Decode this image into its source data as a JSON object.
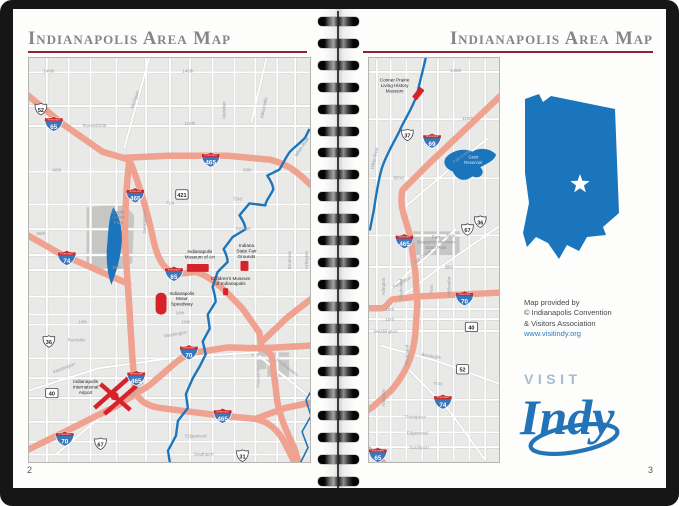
{
  "window": {
    "left_title": "Indianapolis Area Map",
    "right_title": "Indianapolis Area Map",
    "left_page_number": "2",
    "right_page_number": "3"
  },
  "colors": {
    "highway_salmon": "#efa28f",
    "water_blue": "#1b75bc",
    "interstate_blue": "#3b76ba",
    "interstate_red": "#c42c30",
    "poi_red": "#d6232b",
    "state_blue": "#1b75bc",
    "title_gray": "#85868b",
    "rule_maroon": "#8e2133",
    "logo_blue": "#2273b8",
    "visit_gray": "#a5bccf"
  },
  "shield_caption": "INTERSTATE",
  "left_map": {
    "shields": [
      {
        "style": "us",
        "label": "52",
        "x": 12,
        "y": 51
      },
      {
        "style": "interstate",
        "label": "65",
        "x": 25,
        "y": 66
      },
      {
        "style": "interstate",
        "label": "465",
        "x": 183,
        "y": 102
      },
      {
        "style": "box",
        "label": "421",
        "x": 154,
        "y": 137
      },
      {
        "style": "interstate",
        "label": "465",
        "x": 107,
        "y": 138
      },
      {
        "style": "interstate",
        "label": "74",
        "x": 38,
        "y": 201
      },
      {
        "style": "interstate",
        "label": "65",
        "x": 146,
        "y": 217
      },
      {
        "style": "us",
        "label": "36",
        "x": 20,
        "y": 285
      },
      {
        "style": "interstate",
        "label": "70",
        "x": 161,
        "y": 296
      },
      {
        "style": "interstate",
        "label": "465",
        "x": 108,
        "y": 322
      },
      {
        "style": "box",
        "label": "40",
        "x": 23,
        "y": 337
      },
      {
        "style": "interstate",
        "label": "70",
        "x": 36,
        "y": 383
      },
      {
        "style": "us",
        "label": "67",
        "x": 72,
        "y": 388
      },
      {
        "style": "interstate",
        "label": "465",
        "x": 195,
        "y": 360
      },
      {
        "style": "us",
        "label": "31",
        "x": 215,
        "y": 400
      }
    ],
    "labels": [
      {
        "lines": [
          "146th"
        ],
        "x": 20,
        "y": 14
      },
      {
        "lines": [
          "146th"
        ],
        "x": 160,
        "y": 14
      },
      {
        "lines": [
          "Russell/206"
        ],
        "x": 66,
        "y": 69
      },
      {
        "lines": [
          "116th"
        ],
        "x": 162,
        "y": 67
      },
      {
        "lines": [
          "86th"
        ],
        "x": 28,
        "y": 114
      },
      {
        "lines": [
          "86th"
        ],
        "x": 220,
        "y": 114
      },
      {
        "lines": [
          "Michigan"
        ],
        "x": 108,
        "y": 42,
        "rot": -72
      },
      {
        "lines": [
          "Meridian"
        ],
        "x": 198,
        "y": 52,
        "rot": -90
      },
      {
        "lines": [
          "Allisonville"
        ],
        "x": 238,
        "y": 50,
        "rot": -78
      },
      {
        "lines": [
          "71st"
        ],
        "x": 142,
        "y": 147
      },
      {
        "lines": [
          "73rd"
        ],
        "x": 210,
        "y": 143
      },
      {
        "lines": [
          "Georgetown"
        ],
        "x": 118,
        "y": 164,
        "rot": -90
      },
      {
        "lines": [
          "56th"
        ],
        "x": 12,
        "y": 178
      },
      {
        "lines": [
          "Kessler"
        ],
        "x": 216,
        "y": 173
      },
      {
        "lines": [
          "38th"
        ],
        "x": 88,
        "y": 212
      },
      {
        "lines": [
          "16th"
        ],
        "x": 152,
        "y": 258
      },
      {
        "lines": [
          "10th"
        ],
        "x": 54,
        "y": 267
      },
      {
        "lines": [
          "10th"
        ],
        "x": 158,
        "y": 267
      },
      {
        "lines": [
          "Rockville"
        ],
        "x": 48,
        "y": 285
      },
      {
        "lines": [
          "Washington"
        ],
        "x": 148,
        "y": 279,
        "rot": -10
      },
      {
        "lines": [
          "Washington"
        ],
        "x": 36,
        "y": 313,
        "rot": -22
      },
      {
        "lines": [
          "Keystone"
        ],
        "x": 232,
        "y": 322,
        "rot": -90
      },
      {
        "lines": [
          "Southeastern"
        ],
        "x": 259,
        "y": 312,
        "rot": 38
      },
      {
        "lines": [
          "Arlington"
        ],
        "x": 281,
        "y": 203,
        "rot": -90
      },
      {
        "lines": [
          "Emerson"
        ],
        "x": 264,
        "y": 203,
        "rot": -90
      },
      {
        "lines": [
          "Kentucky"
        ],
        "x": 110,
        "y": 334,
        "rot": -52
      },
      {
        "lines": [
          "Edgewood"
        ],
        "x": 168,
        "y": 382
      },
      {
        "lines": [
          "Southport"
        ],
        "x": 176,
        "y": 400
      }
    ],
    "areas": [
      {
        "lines": [
          "Eagle",
          "Creek",
          "Park"
        ],
        "x": 90,
        "y": 156
      }
    ],
    "waters": [
      {
        "lines": [
          "White River"
        ],
        "x": 276,
        "y": 90,
        "rot": -55
      }
    ],
    "pois": [
      {
        "lines": [
          "Indianapolis",
          "Museum of Art"
        ],
        "x": 172,
        "y": 196,
        "marker": {
          "kind": "rect",
          "x": 170,
          "y": 211,
          "w": 22,
          "h": 8,
          "rx": 1
        }
      },
      {
        "lines": [
          "Indiana",
          "State Fair",
          "Grounds"
        ],
        "x": 219,
        "y": 190,
        "marker": {
          "kind": "rect",
          "x": 217,
          "y": 209,
          "w": 8,
          "h": 10,
          "rx": 1
        }
      },
      {
        "lines": [
          "Children's Museum",
          "of Indianapolis"
        ],
        "x": 203,
        "y": 223,
        "marker": {
          "kind": "rect",
          "x": 198,
          "y": 235,
          "w": 5,
          "h": 7,
          "rx": 0.5
        }
      },
      {
        "lines": [
          "Indianapolis",
          "Motor",
          "Speedway"
        ],
        "x": 154,
        "y": 238,
        "marker": {
          "kind": "rect",
          "x": 133,
          "y": 247,
          "w": 11,
          "h": 22,
          "rx": 5
        }
      },
      {
        "lines": [
          "Indianapolis",
          "International",
          "Airport"
        ],
        "x": 57,
        "y": 327,
        "marker": {
          "kind": "airport",
          "x": 86,
          "y": 338
        }
      }
    ]
  },
  "right_map": {
    "shields": [
      {
        "style": "us",
        "label": "37",
        "x": 39,
        "y": 76
      },
      {
        "style": "interstate",
        "label": "69",
        "x": 64,
        "y": 82
      },
      {
        "style": "interstate",
        "label": "465",
        "x": 36,
        "y": 184
      },
      {
        "style": "us",
        "label": "36",
        "x": 113,
        "y": 164
      },
      {
        "style": "us",
        "label": "67",
        "x": 100,
        "y": 172
      },
      {
        "style": "interstate",
        "label": "70",
        "x": 97,
        "y": 242
      },
      {
        "style": "box",
        "label": "40",
        "x": 104,
        "y": 271
      },
      {
        "style": "box",
        "label": "52",
        "x": 95,
        "y": 314
      },
      {
        "style": "interstate",
        "label": "74",
        "x": 75,
        "y": 347
      },
      {
        "style": "interstate",
        "label": "65",
        "x": 9,
        "y": 401
      }
    ],
    "labels": [
      {
        "lines": [
          "146th"
        ],
        "x": 88,
        "y": 12
      },
      {
        "lines": [
          "116th"
        ],
        "x": 100,
        "y": 61
      },
      {
        "lines": [
          "82nd"
        ],
        "x": 30,
        "y": 121
      },
      {
        "lines": [
          "Fall Creek"
        ],
        "x": 95,
        "y": 99,
        "rot": -36
      },
      {
        "lines": [
          "56th"
        ],
        "x": 83,
        "y": 180
      },
      {
        "lines": [
          "Fall Creek"
        ],
        "x": 55,
        "y": 201,
        "rot": -36
      },
      {
        "lines": [
          "38th"
        ],
        "x": 81,
        "y": 212
      },
      {
        "lines": [
          "Pendleton"
        ],
        "x": 34,
        "y": 227,
        "rot": -30
      },
      {
        "lines": [
          "16th"
        ],
        "x": 21,
        "y": 255
      },
      {
        "lines": [
          "10th"
        ],
        "x": 21,
        "y": 265
      },
      {
        "lines": [
          "Washington"
        ],
        "x": 17,
        "y": 277
      },
      {
        "lines": [
          "Arlington"
        ],
        "x": 16,
        "y": 230,
        "rot": -90
      },
      {
        "lines": [
          "Shadeland"
        ],
        "x": 34,
        "y": 233,
        "rot": -90
      },
      {
        "lines": [
          "Post"
        ],
        "x": 65,
        "y": 233,
        "rot": -90
      },
      {
        "lines": [
          "Mitthoefer"
        ],
        "x": 83,
        "y": 230,
        "rot": -90
      },
      {
        "lines": [
          "Brookville"
        ],
        "x": 63,
        "y": 302,
        "rot": 10
      },
      {
        "lines": [
          "Troy"
        ],
        "x": 70,
        "y": 330
      },
      {
        "lines": [
          "Shadeland"
        ],
        "x": 40,
        "y": 300,
        "rot": -90
      },
      {
        "lines": [
          "Thompson"
        ],
        "x": 47,
        "y": 364
      },
      {
        "lines": [
          "Edgewood"
        ],
        "x": 49,
        "y": 380
      },
      {
        "lines": [
          "Southport"
        ],
        "x": 51,
        "y": 395
      },
      {
        "lines": [
          "Arlington"
        ],
        "x": 16,
        "y": 343,
        "rot": -90
      }
    ],
    "areas": [
      {
        "lines": [
          "Fort",
          "Benjamin Harrison",
          "State Park"
        ],
        "x": 68,
        "y": 181
      }
    ],
    "waters": [
      {
        "lines": [
          "White River"
        ],
        "x": 7,
        "y": 100,
        "rot": -78
      },
      {
        "lines": [
          "Geist",
          "Reservoir"
        ],
        "x": 106,
        "y": 100,
        "on_water": true
      }
    ],
    "pois": [
      {
        "lines": [
          "Conner Prairie",
          "Living History",
          "Museum"
        ],
        "x": 26,
        "y": 22,
        "marker": {
          "kind": "rect",
          "x": 50,
          "y": 34,
          "w": 6,
          "h": 13,
          "rx": 1,
          "rot": 38
        }
      }
    ]
  },
  "sidebar": {
    "credit_lines": [
      "Map provided by",
      "© Indianapolis Convention",
      "& Visitors Association"
    ],
    "link": "www.visitindy.org",
    "visit": "VISIT",
    "indy": "Indy"
  }
}
